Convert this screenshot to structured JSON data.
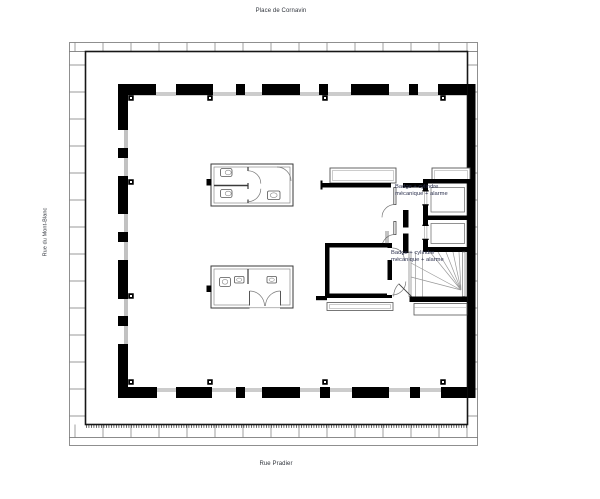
{
  "labels": {
    "top_street": "Place de Cornavin",
    "left_street": "Rue du Mont-Blanc",
    "bottom_street": "Rue Pradier"
  },
  "annotations": [
    {
      "line1": "Badge + cylindre",
      "line2": "mécanique + alarme"
    },
    {
      "line1": "Badge + cylindre",
      "line2": "mécanique + alarme"
    }
  ],
  "colors": {
    "background": "#ffffff",
    "wall_color": "#000000",
    "drawing_line_color": "#555555",
    "site_line_color": "#8f8f8f",
    "label_color": "#30343c",
    "annotation_color": "#2e3350"
  }
}
